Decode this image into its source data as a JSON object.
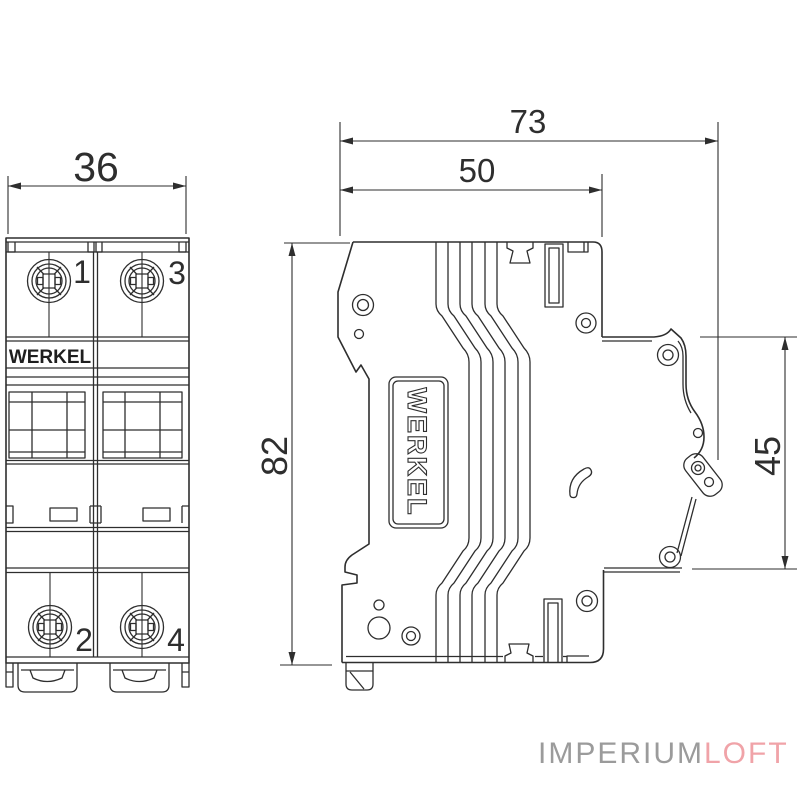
{
  "drawing": {
    "subject": "2-pole circuit breaker dimensional drawing, front and side views",
    "views": {
      "front": {
        "brand": "WERKEL",
        "terminals": {
          "top_left": "1",
          "top_right": "3",
          "bottom_left": "2",
          "bottom_right": "4"
        },
        "width_mm": "36"
      },
      "side": {
        "brand": "WERKEL",
        "overall_width_mm": "73",
        "body_width_mm": "50",
        "height_mm": "82",
        "front_depth_mm": "45"
      }
    },
    "watermark": {
      "gray_part": "IMPERIUM",
      "accent_part": "LOFT",
      "gray_color": "#9b9b9b",
      "accent_color": "#f0a3a8"
    },
    "colors": {
      "line": "#2e2e2e",
      "background": "#ffffff"
    }
  }
}
